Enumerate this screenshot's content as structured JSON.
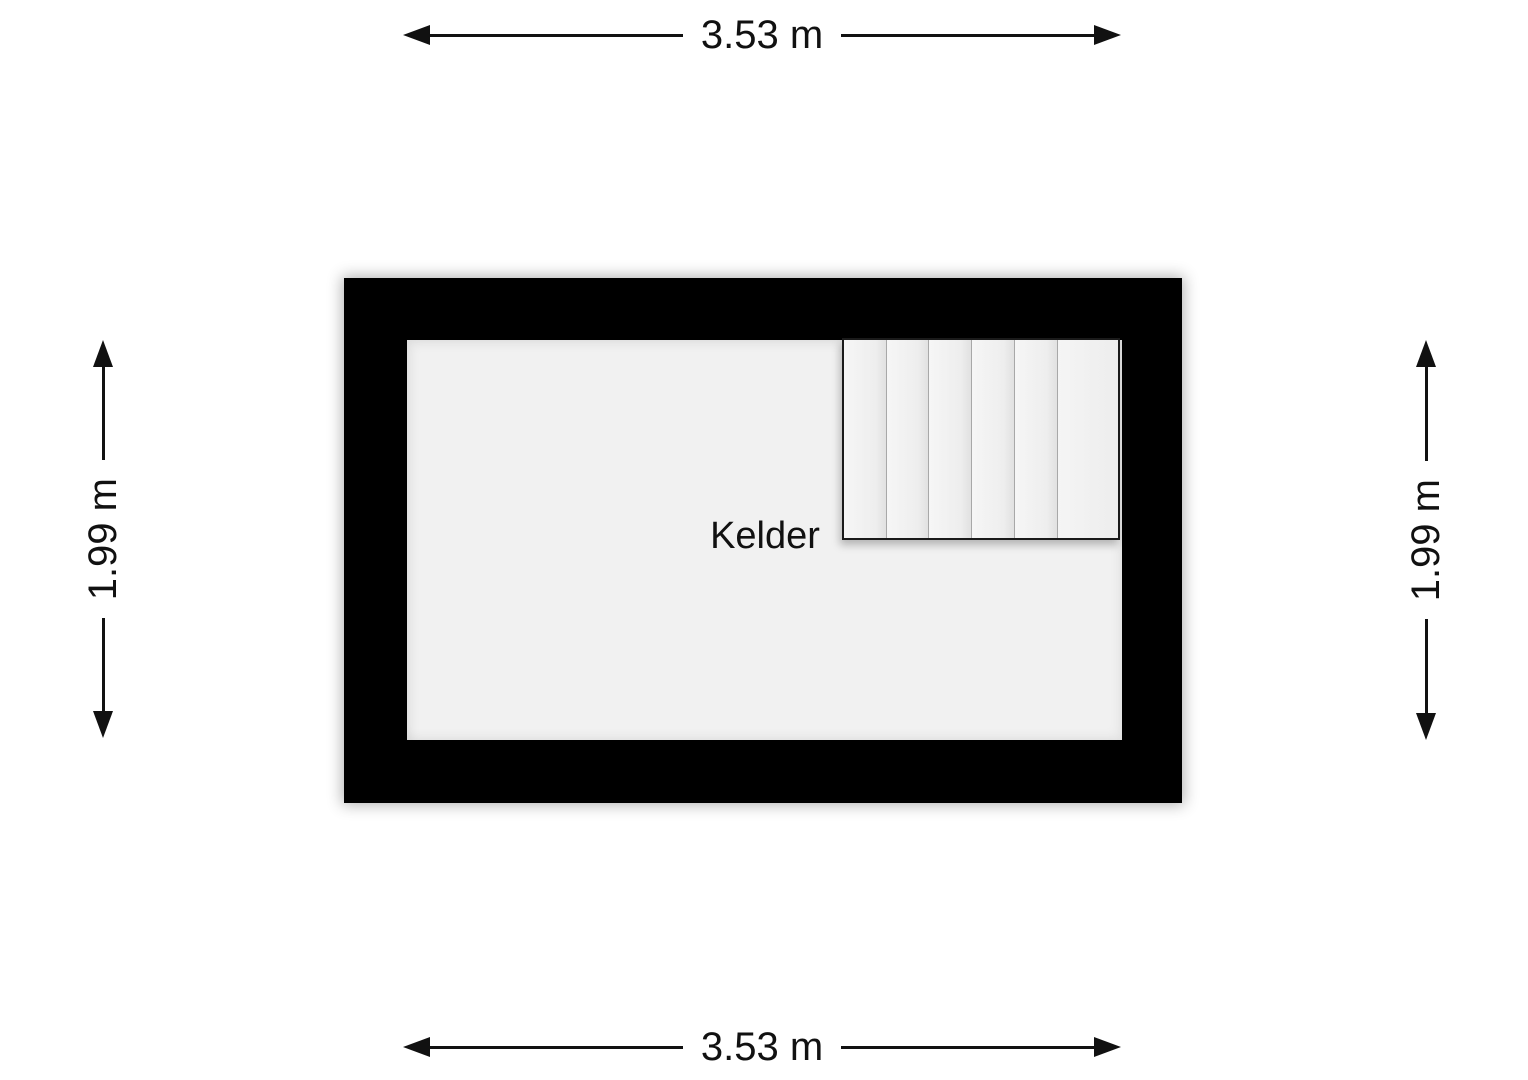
{
  "floorplan": {
    "room_label": "Kelder",
    "dimensions": {
      "top": {
        "label": "3.53 m"
      },
      "bottom": {
        "label": "3.53 m"
      },
      "left": {
        "label": "1.99 m"
      },
      "right": {
        "label": "1.99 m"
      }
    },
    "stairs": {
      "tread_count": 6
    },
    "colors": {
      "wall": "#000000",
      "room_fill": "#f1f1f1",
      "background": "#ffffff",
      "dimension_line": "#111111",
      "stair_divider": "#a8a8a8"
    }
  }
}
